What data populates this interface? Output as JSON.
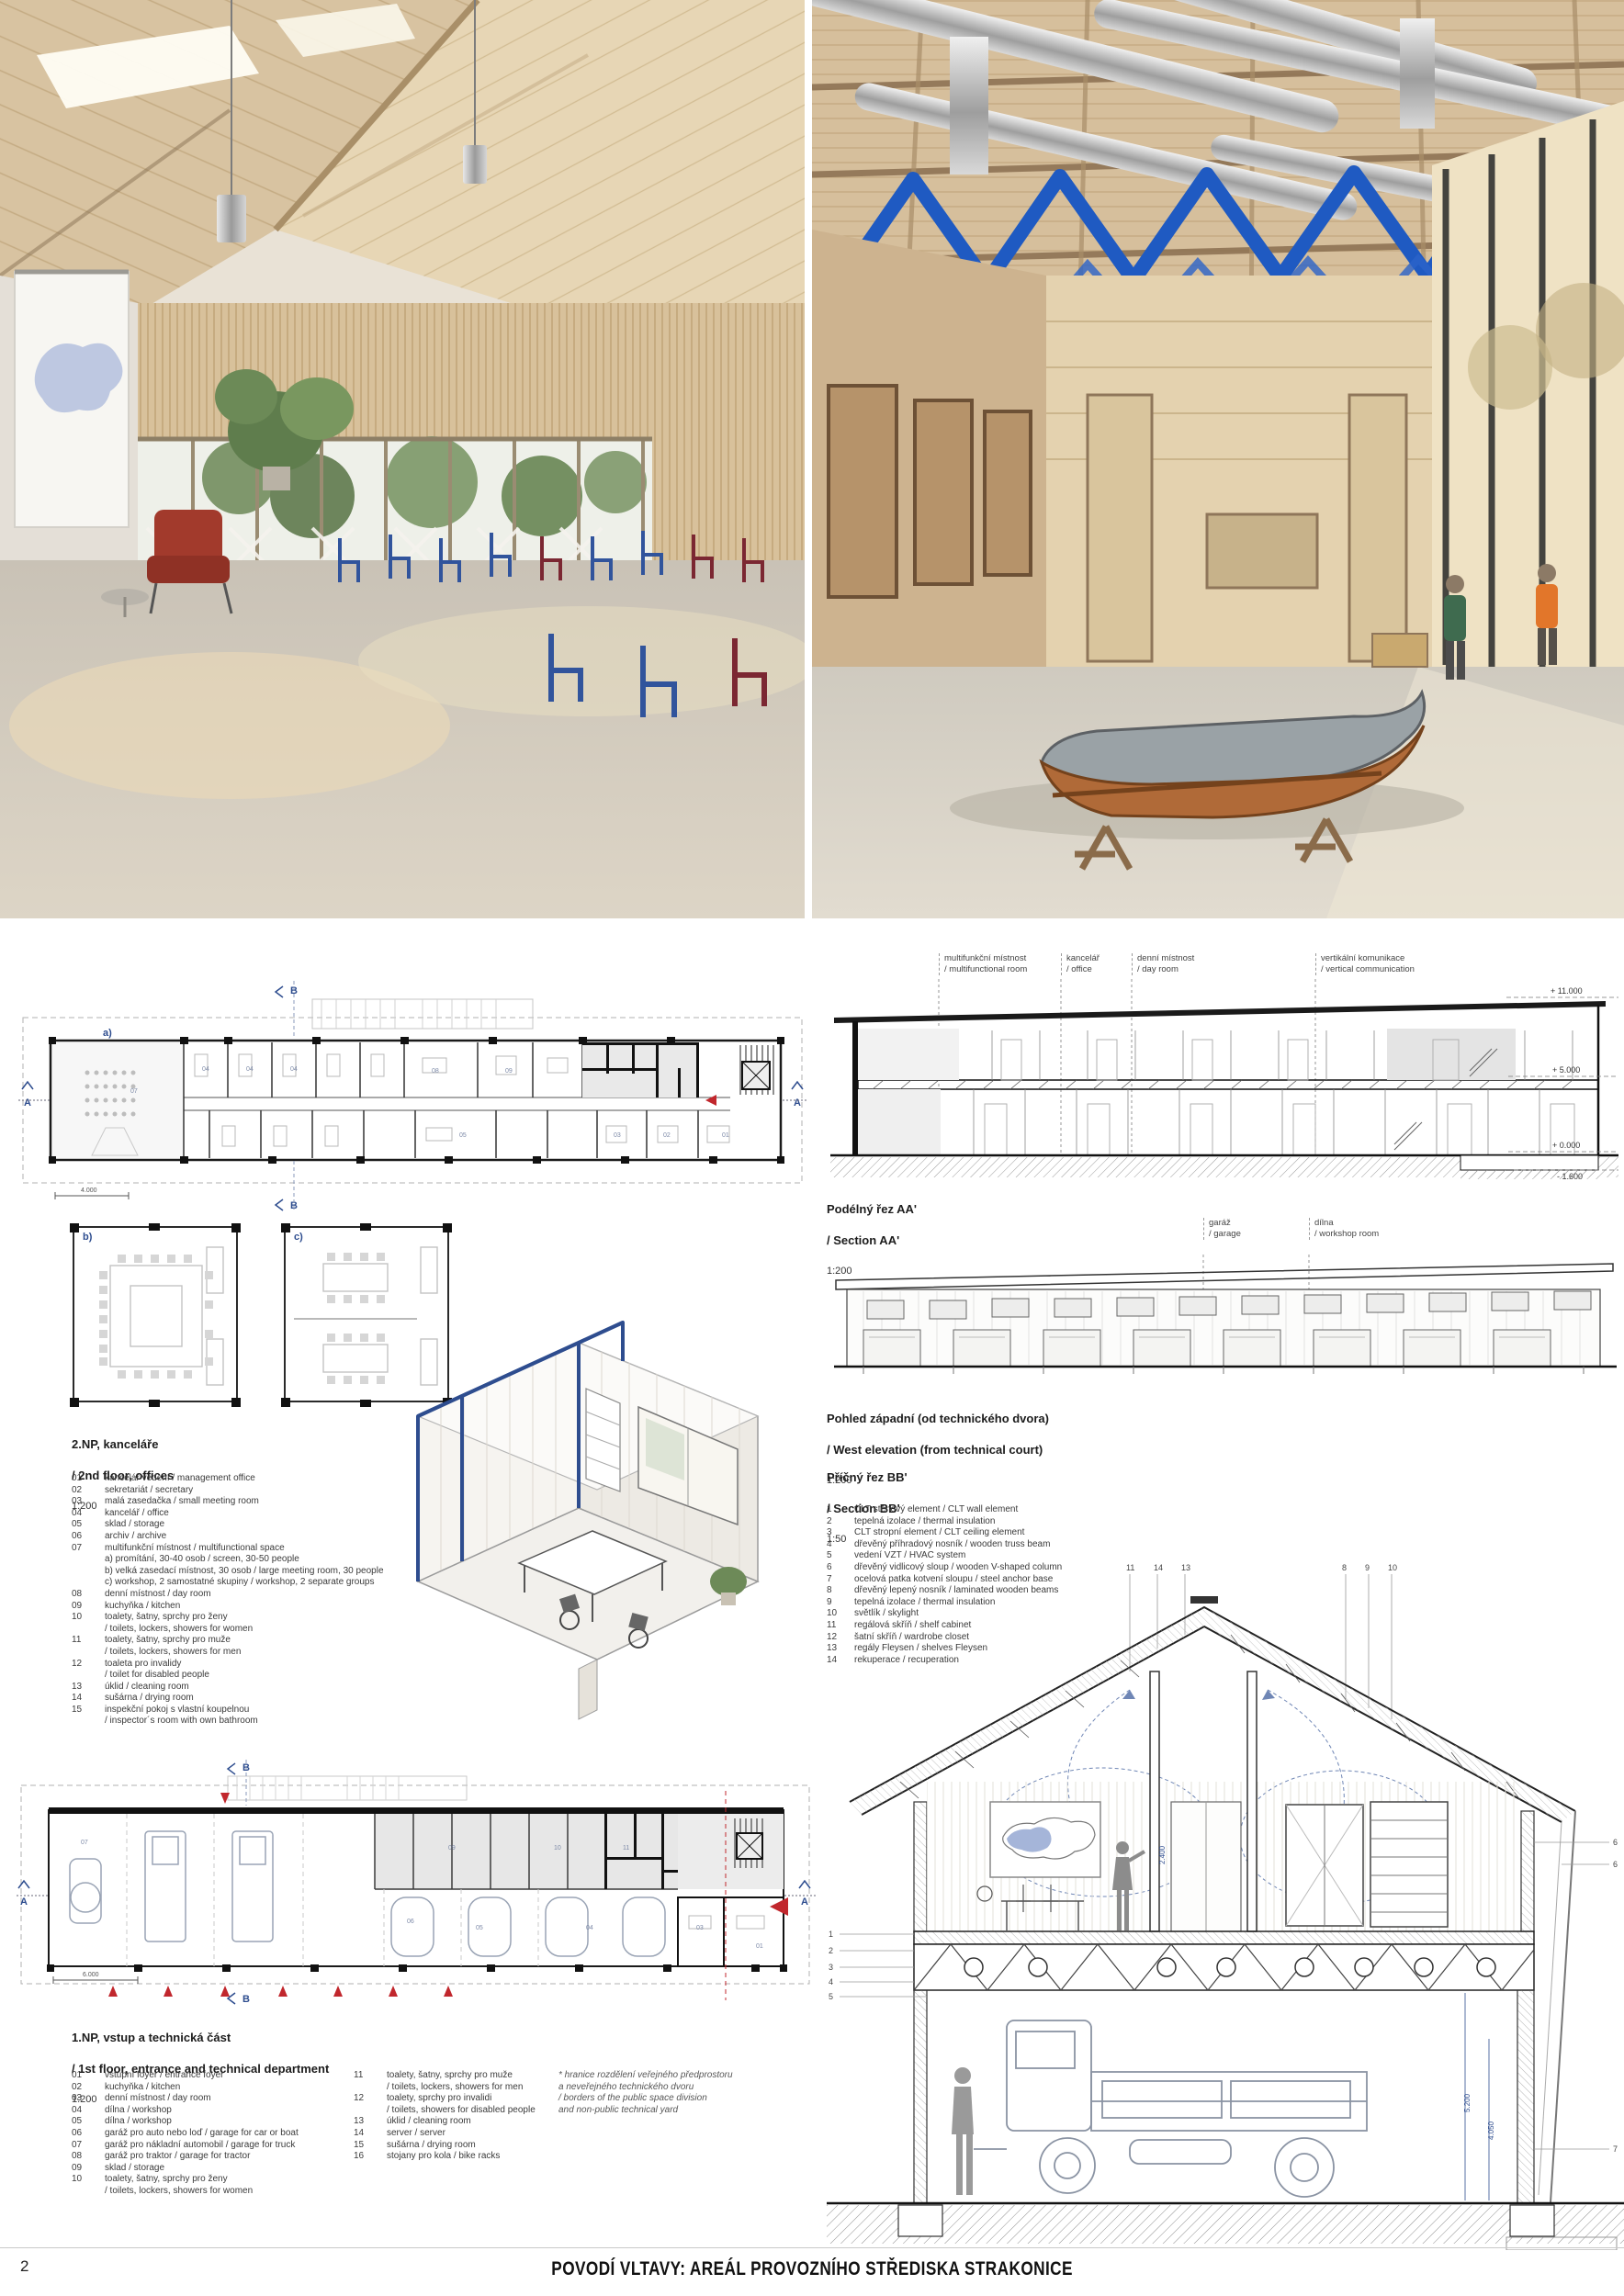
{
  "colors": {
    "accent_blue": "#2e4d8f",
    "zigzag_blue": "#1f5ac2",
    "marker_red": "#c1272d",
    "wood": "#d9c3a0",
    "poche": "#111111"
  },
  "footer": {
    "page_number": "2",
    "title": "POVODÍ VLTAVY: AREÁL PROVOZNÍHO STŘEDISKA STRAKONICE"
  },
  "photos": {
    "left_alt": "interior – attic meeting room",
    "right_alt": "interior – workshop hall with boat"
  },
  "plan2np": {
    "title_cs": "2.NP, kanceláře",
    "title_en": "/ 2nd floor, offices",
    "scale": "1:200",
    "mark_a": "A",
    "mark_b": "B",
    "sub_a": "a)",
    "scalebar": "4.000",
    "rooms": [
      "07",
      "04",
      "04",
      "04",
      "08",
      "09",
      "05",
      "03",
      "02",
      "01"
    ],
    "legend": [
      {
        "n": "01",
        "t": "kancelář vedení / management office"
      },
      {
        "n": "02",
        "t": "sekretariát / secretary"
      },
      {
        "n": "03",
        "t": "malá zasedačka / small meeting room"
      },
      {
        "n": "04",
        "t": "kancelář / office"
      },
      {
        "n": "05",
        "t": "sklad / storage"
      },
      {
        "n": "06",
        "t": "archiv / archive"
      },
      {
        "n": "07",
        "t": "multifunkční místnost / multifunctional space"
      },
      {
        "n": "",
        "t": "a) promítání, 30-40 osob / screen, 30-50 people"
      },
      {
        "n": "",
        "t": "b) velká zasedací místnost, 30 osob / large meeting room, 30 people"
      },
      {
        "n": "",
        "t": "c) workshop, 2 samostatné skupiny / workshop, 2 separate groups"
      },
      {
        "n": "08",
        "t": "denní místnost / day room"
      },
      {
        "n": "09",
        "t": "kuchyňka / kitchen"
      },
      {
        "n": "10",
        "t": "toalety, šatny, sprchy pro ženy"
      },
      {
        "n": "",
        "t": "/ toilets, lockers, showers for women"
      },
      {
        "n": "11",
        "t": "toalety, šatny, sprchy pro muže"
      },
      {
        "n": "",
        "t": "/ toilets, lockers, showers for men"
      },
      {
        "n": "12",
        "t": "toaleta pro invalidy"
      },
      {
        "n": "",
        "t": "/ toilet for disabled people"
      },
      {
        "n": "13",
        "t": "úklid / cleaning room"
      },
      {
        "n": "14",
        "t": "sušárna / drying room"
      },
      {
        "n": "15",
        "t": "inspekční pokoj s vlastní koupelnou"
      },
      {
        "n": "",
        "t": "/ inspector´s room with own bathroom"
      }
    ],
    "sub_b": "b)",
    "sub_c": "c)"
  },
  "plan1np": {
    "title_cs": "1.NP, vstup a technická část",
    "title_en": "/ 1st floor, entrance and technical department",
    "scale": "1:200",
    "mark_a": "A",
    "mark_b": "B",
    "scalebar": "6.000",
    "rooms": [
      "07",
      "09",
      "06",
      "10",
      "11",
      "05",
      "04",
      "03",
      "01"
    ],
    "legend_col1": [
      {
        "n": "01",
        "t": "vstupní foyer / entrance foyer"
      },
      {
        "n": "02",
        "t": "kuchyňka / kitchen"
      },
      {
        "n": "03",
        "t": "denní místnost / day room"
      },
      {
        "n": "04",
        "t": "dílna / workshop"
      },
      {
        "n": "05",
        "t": "dílna / workshop"
      },
      {
        "n": "06",
        "t": "garáž pro auto nebo loď / garage for car or boat"
      },
      {
        "n": "07",
        "t": "garáž pro nákladní automobil / garage for truck"
      },
      {
        "n": "08",
        "t": "garáž pro traktor / garage for tractor"
      },
      {
        "n": "09",
        "t": "sklad / storage"
      },
      {
        "n": "10",
        "t": "toalety, šatny, sprchy pro ženy"
      },
      {
        "n": "",
        "t": "/ toilets, lockers, showers for women"
      }
    ],
    "legend_col2": [
      {
        "n": "11",
        "t": "toalety, šatny, sprchy pro muže"
      },
      {
        "n": "",
        "t": "/ toilets, lockers, showers for men"
      },
      {
        "n": "12",
        "t": "toalety, sprchy pro invalidi"
      },
      {
        "n": "",
        "t": "/ toilets, showers for disabled people"
      },
      {
        "n": "13",
        "t": "úklid / cleaning room"
      },
      {
        "n": "14",
        "t": "server / server"
      },
      {
        "n": "15",
        "t": "sušárna / drying room"
      },
      {
        "n": "16",
        "t": "stojany pro kola / bike racks"
      }
    ],
    "note_lines": [
      "* hranice rozdělení veřejného předprostoru",
      "a neveřejného technického dvoru",
      "/ borders of the public space division",
      "and non-public technical yard"
    ]
  },
  "sectionAA": {
    "title_cs": "Podélný řez AA'",
    "title_en": "/ Section AA'",
    "scale": "1:200",
    "labels": [
      {
        "cs": "multifunkční místnost",
        "en": "/ multifunctional room"
      },
      {
        "cs": "kancelář",
        "en": "/ office"
      },
      {
        "cs": "denní místnost",
        "en": "/ day room"
      },
      {
        "cs": "vertikální komunikace",
        "en": "/ vertical communication"
      }
    ],
    "elevations": [
      "+ 11.000",
      "+ 5.000",
      "+ 0.000",
      "- 1.600"
    ]
  },
  "west": {
    "title_cs": "Pohled západní (od technického dvora)",
    "title_en": "/ West elevation (from technical court)",
    "scale": "1:200",
    "labels": [
      {
        "cs": "garáž",
        "en": "/ garage"
      },
      {
        "cs": "dílna",
        "en": "/ workshop room"
      }
    ]
  },
  "sectionBB": {
    "title_cs": "Příčný řez BB'",
    "title_en": "/ Section BB'",
    "scale": "1:50",
    "legend": [
      {
        "n": "1",
        "t": "CLT stěnový element / CLT wall element"
      },
      {
        "n": "2",
        "t": "tepelná izolace / thermal insulation"
      },
      {
        "n": "3",
        "t": "CLT stropní element / CLT ceiling element"
      },
      {
        "n": "4",
        "t": "dřevěný příhradový nosník / wooden truss beam"
      },
      {
        "n": "5",
        "t": "vedení VZT / HVAC system"
      },
      {
        "n": "6",
        "t": "dřevěný vidlicový sloup / wooden V-shaped column"
      },
      {
        "n": "7",
        "t": "ocelová patka kotvení sloupu / steel anchor base"
      },
      {
        "n": "8",
        "t": "dřevěný lepený nosník / laminated wooden beams"
      },
      {
        "n": "9",
        "t": "tepelná izolace / thermal insulation"
      },
      {
        "n": "10",
        "t": "světlík / skylight"
      },
      {
        "n": "11",
        "t": "regálová skříň / shelf cabinet"
      },
      {
        "n": "12",
        "t": "šatní skříň / wardrobe closet"
      },
      {
        "n": "13",
        "t": "regály Fleysen / shelves Fleysen"
      },
      {
        "n": "14",
        "t": "rekuperace / recuperation"
      }
    ],
    "callouts_left": [
      "1",
      "2",
      "3",
      "4",
      "5"
    ],
    "callouts_top": [
      "11",
      "14",
      "13",
      "8",
      "9",
      "10"
    ],
    "callouts_right": [
      "6",
      "6",
      "7"
    ],
    "dims": [
      "2.400",
      "5.200",
      "4.050"
    ]
  }
}
